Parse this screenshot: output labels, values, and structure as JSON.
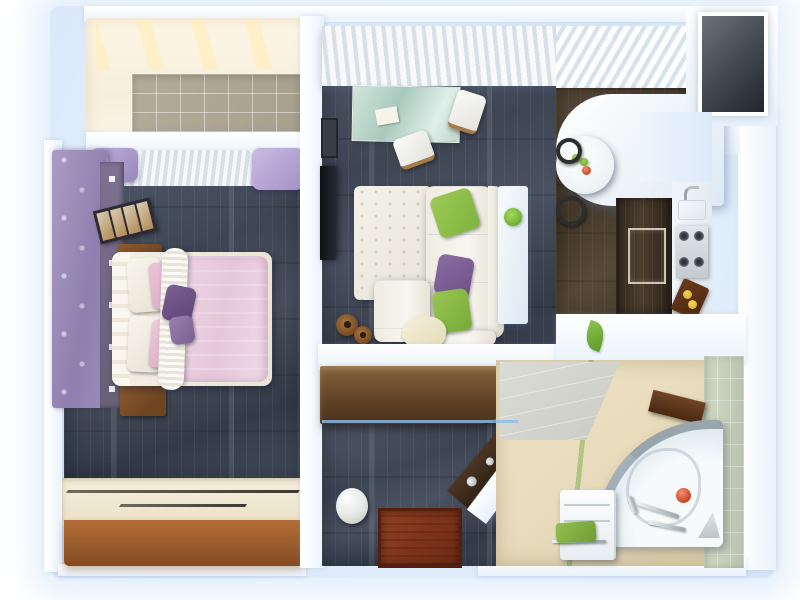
{
  "scene": {
    "kind": "3d-rendered-apartment-floor-plan",
    "view": "top-down",
    "rooms": [
      {
        "name": "balcony",
        "floor": "beige-ceramic-tile",
        "items": [
          "tiled-floor"
        ]
      },
      {
        "name": "bedroom",
        "floor": "dark-wood-plank",
        "items": [
          "double-bed",
          "white-pillows",
          "pink-pillows",
          "purple-accent-pillows",
          "pink-duvet",
          "white-runner-blanket",
          "purple-wardrobe",
          "shelf-column",
          "photo-ledge",
          "nightstand-upper",
          "nightstand-lower",
          "window-pane",
          "pleated-curtain",
          "purple-drapes",
          "sliding-door-wardrobe"
        ]
      },
      {
        "name": "living-room",
        "floor": "dark-wood-plank",
        "items": [
          "vertical-blinds",
          "glass-desk",
          "desk-paper",
          "desk-chair-right",
          "desk-chair-bottom",
          "wall-tv",
          "wall-picture",
          "white-shag-rug",
          "corner-sofa",
          "sofa-chaise",
          "green-pillow-top",
          "purple-pillow",
          "green-pillow-bottom",
          "cream-pillow",
          "glass-console",
          "potted-plant",
          "pouf-large",
          "pouf-small"
        ]
      },
      {
        "name": "kitchen",
        "floor": "brown-wood-plank",
        "items": [
          "white-bar-counter",
          "round-dining-table",
          "green-apples",
          "red-apple",
          "bar-stool-upper",
          "bar-stool-lower",
          "tall-oven-cabinet",
          "sink-faucet",
          "sink-basin",
          "cooktop-four-burners",
          "cutting-board",
          "lemons",
          "ventilation-shaft"
        ]
      },
      {
        "name": "hallway",
        "floor": "dark-wood-plank",
        "items": [
          "built-in-closet",
          "umbrella-stand-vase",
          "entry-doormat",
          "angled-shoe-console"
        ]
      },
      {
        "name": "bathroom",
        "floor": "beige-tile-green-stripe",
        "items": [
          "corner-bathtub",
          "washing-machine",
          "green-towel",
          "towel-rail",
          "shower-fittings",
          "red-sponge-ball",
          "gray-wedge",
          "wood-wall-shelf",
          "green-tile-wall",
          "gray-entry-tiles",
          "leaf-wall-decal"
        ]
      }
    ]
  },
  "colors": {
    "pageBg": "#ffffff",
    "glowLight": "#f0f7ff",
    "glowMid": "#e2eefb",
    "glowDeep": "#d5e5f7",
    "wall": "#ffffff",
    "wallShade": "#e9f2fb",
    "balconyTile": "#b4ab9a",
    "floorDark": "#434a58",
    "floorBrown": "#4b3f30",
    "bathFloor": "#e9dcbd",
    "wardrobePurple": "#9d8cba",
    "duvetPink": "#e9cde0",
    "accentGreen": "#8cc14e",
    "accentPurple": "#7b5d8f",
    "woodBrown": "#8f5c32",
    "hallClosetBrown": "#5f4226",
    "doormatRed": "#7a3019",
    "tubRim": "#99a5ad",
    "applesRed": "#c84426"
  }
}
